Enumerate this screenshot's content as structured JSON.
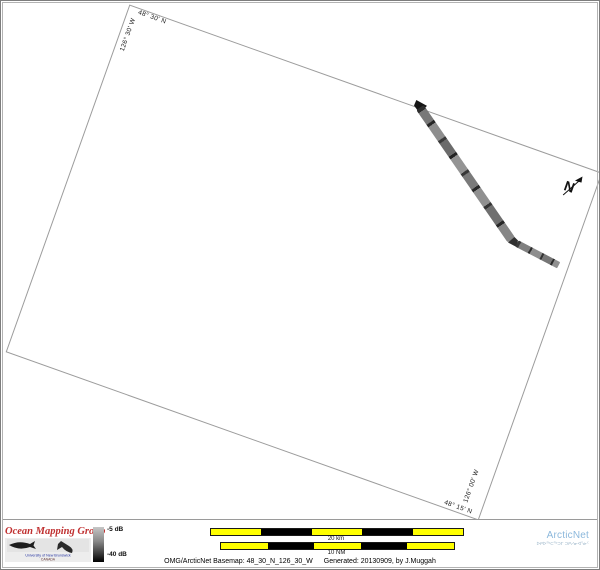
{
  "map": {
    "corner_labels": {
      "top_lat": "48° 30' N",
      "left_lon": "126° 30' W",
      "bottom_lat": "48° 15' N",
      "right_lon": "126° 00' W"
    },
    "north_label": "N",
    "boundary_color": "#9c9c9c"
  },
  "colorbar": {
    "top_label": "-5 dB",
    "bottom_label": "-40 dB",
    "top_color": "#c6c6c6",
    "bottom_color": "#000000"
  },
  "scalebars": {
    "km_label": "20 km",
    "nm_label": "10 NM",
    "segment_colors": [
      "#ffff00",
      "#000000",
      "#ffff00",
      "#000000",
      "#ffff00"
    ]
  },
  "branding": {
    "omg_title": "Ocean Mapping Group",
    "omg_title_color": "#c03030",
    "omg_sub1": "University of New Brunswick",
    "omg_sub2": "CANADA",
    "arcticnet_name": "ArcticNet",
    "arcticnet_color": "#8cb8dc",
    "arcticnet_syllabics": "ᐅᑭᐅᖅᑕᖅᑐᒥ ᑐᑭᓯᓂᐊᕐᓃᑦ"
  },
  "caption": {
    "basemap": "OMG/ArcticNet Basemap: 48_30_N_126_30_W",
    "generated": "Generated: 20130909, by J.Muggah"
  }
}
